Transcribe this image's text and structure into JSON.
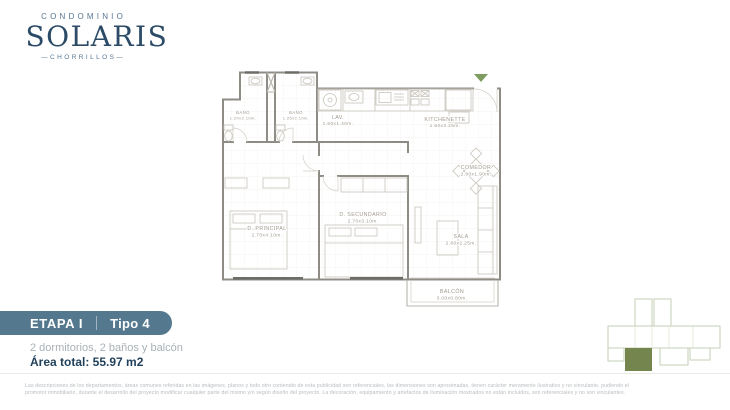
{
  "logo": {
    "condominio": "CONDOMINIO",
    "name": "SOLARIS",
    "location": "—CHORRILLOS—"
  },
  "badge": {
    "etapa": "ETAPA I",
    "tipo": "Tipo 4"
  },
  "summary": {
    "features": "2 dormitorios, 2 baños y balcón",
    "area": "Área total: 55.97 m2"
  },
  "plan": {
    "rooms": [
      {
        "name": "BAÑO",
        "dims": "1.20x2.10m."
      },
      {
        "name": "BAÑO",
        "dims": "1.25x2.10m."
      },
      {
        "name": "LAV.",
        "dims": "1.60x1.40m."
      },
      {
        "name": "KITCHENETTE",
        "dims": "1.60x3.25m."
      },
      {
        "name": "COMEDOR",
        "dims": "2.80x1.90m."
      },
      {
        "name": "D. PRINCIPAL",
        "dims": "2.70x4.10m."
      },
      {
        "name": "D. SECUNDARIO",
        "dims": "2.70x3.10m."
      },
      {
        "name": "SALA",
        "dims": "2.80x2.25m."
      },
      {
        "name": "BALCÓN",
        "dims": "3.00x0.80m."
      }
    ]
  },
  "disclaimer": {
    "line1": "Las descripciones de los departamentos, áreas comunes referidas en las imágenes, planos y todo otro contenido de esta publicidad son referenciales, las dimensiones son aproximadas, tienen carácter meramente ilustrativo y no vinculante, pudiendo el",
    "line2": "promotor inmobiliario, durante el desarrollo del proyecto modificar cualquier parte del mismo y/o según diseño del proyecto. La decoración, equipamiento y artefactos de iluminación mostrados no están incluidos, son referenciales y no son vinculantes."
  },
  "colors": {
    "badge": "#54788e",
    "navy": "#1f3f5a",
    "entry_arrow_green": "#7e9c5f",
    "keyplan_highlight": "#74854d"
  }
}
